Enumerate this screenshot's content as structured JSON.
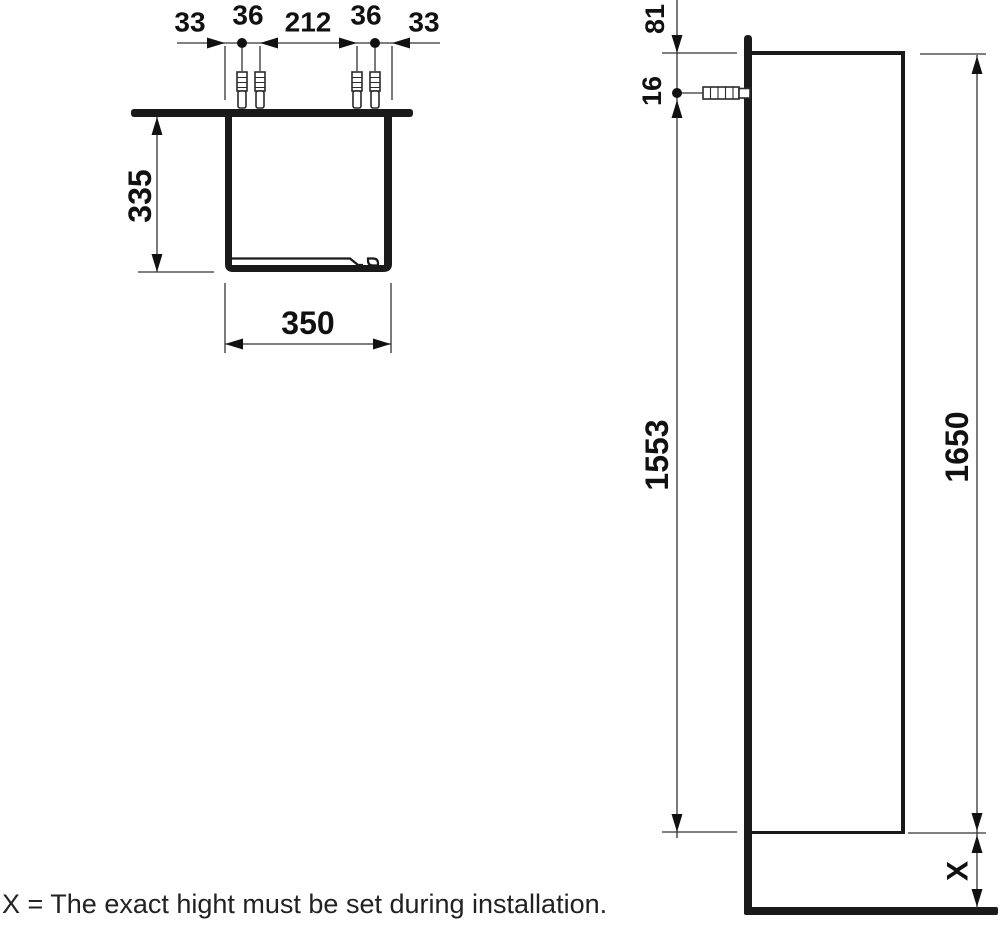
{
  "drawing": {
    "caption": "X = The exact hight must be set during installation.",
    "colors": {
      "object_line": "#1a1a1a",
      "dimension_line": "#333333",
      "background": "#ffffff"
    },
    "plan_view": {
      "chain_labels": [
        "33",
        "36",
        "212",
        "36",
        "33"
      ],
      "depth_label": "335",
      "width_label": "350"
    },
    "side_view": {
      "top_to_anchor_label": "81",
      "anchor_label": "16",
      "anchor_to_bottom_label": "1553",
      "cabinet_height_label": "1650",
      "floor_clearance_label": "X"
    }
  }
}
